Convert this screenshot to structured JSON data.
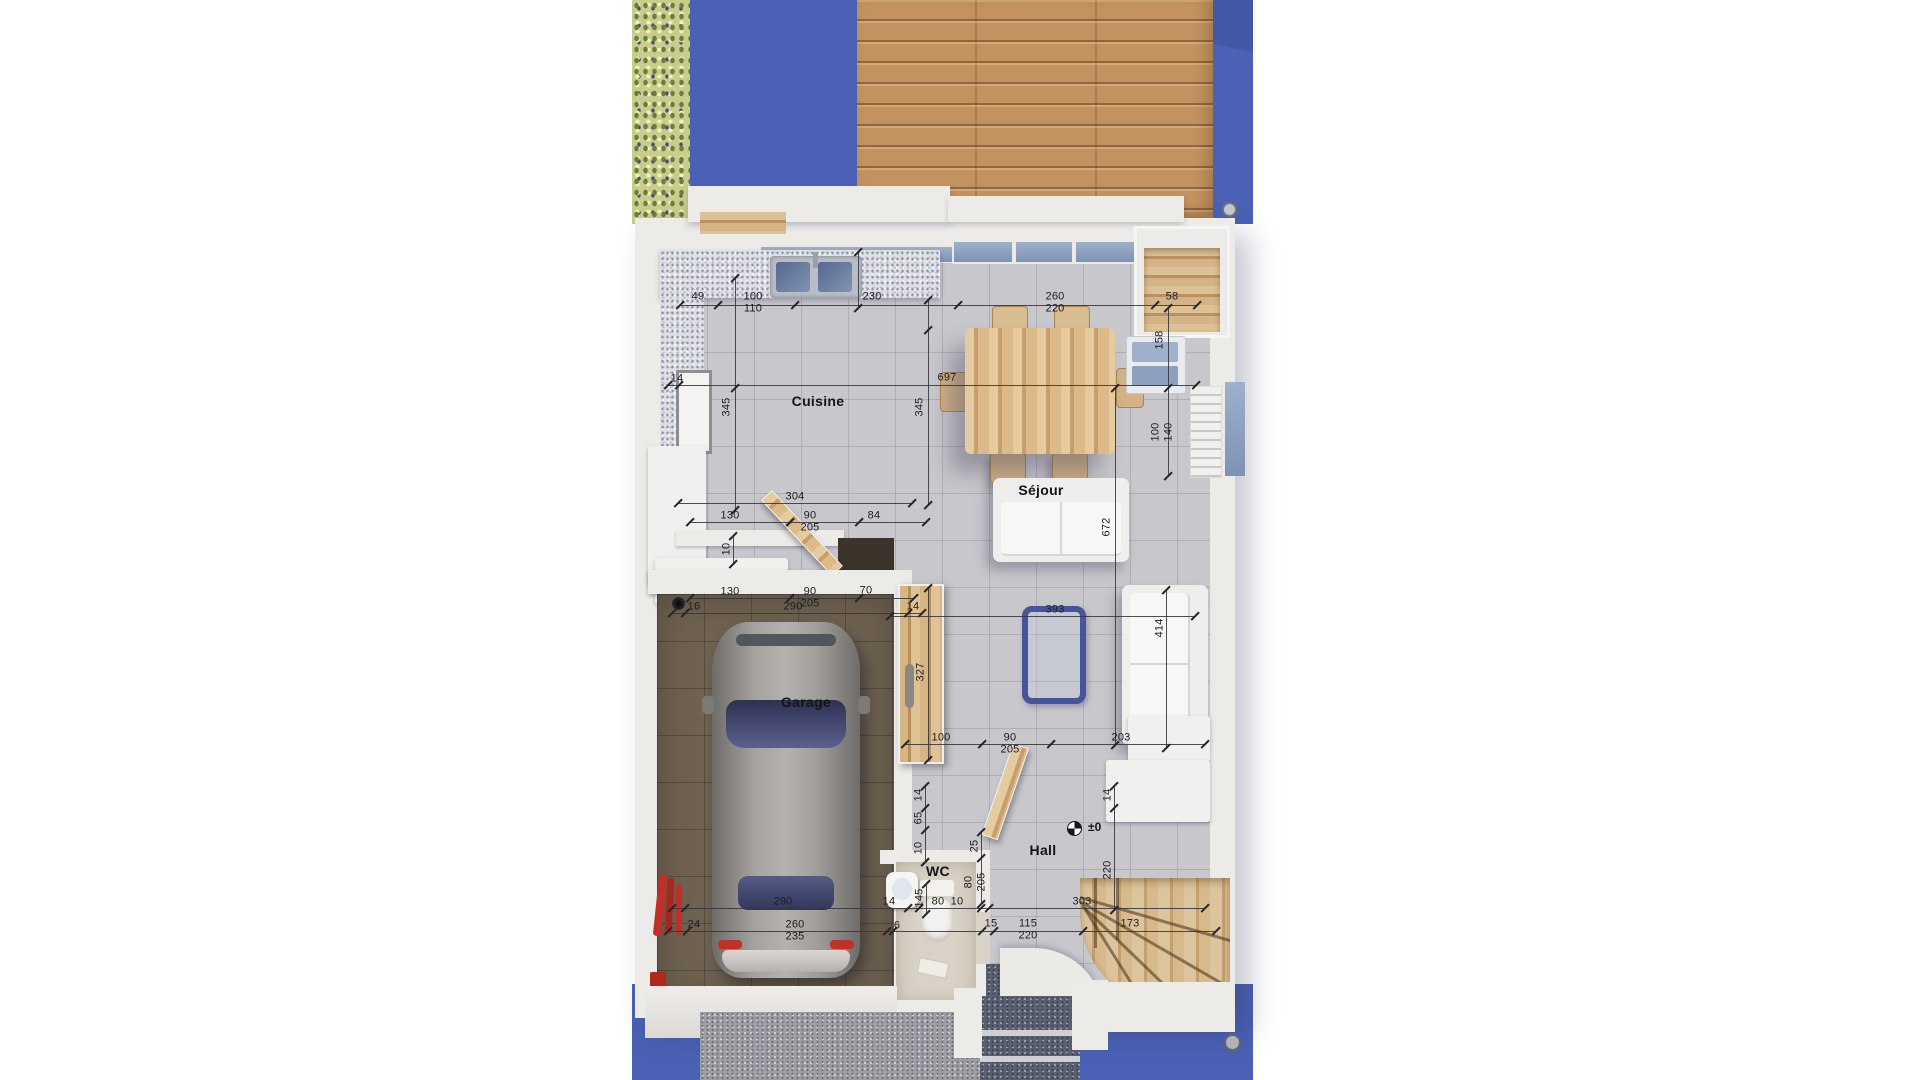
{
  "scene": {
    "type": "3d-rendered-floor-plan",
    "view": "top-down"
  },
  "colors": {
    "ground_blue": "#4a61b5",
    "deck_wood": "#c2935f",
    "hedge_green": "#c9cd8c",
    "wall_white": "#ecebe8",
    "floor_tile": "#c8c7cc",
    "garage_floor": "#6f6251",
    "annotation": "#1c1c1f",
    "coffee_table_blue": "#46549c",
    "taillight_red": "#c03028"
  },
  "room_labels": [
    {
      "id": "cuisine",
      "label": "Cuisine",
      "x": 818,
      "y": 401
    },
    {
      "id": "sejour",
      "label": "Séjour",
      "x": 1041,
      "y": 490
    },
    {
      "id": "garage",
      "label": "Garage",
      "x": 806,
      "y": 702
    },
    {
      "id": "wc",
      "label": "WC",
      "x": 938,
      "y": 871
    },
    {
      "id": "hall",
      "label": "Hall",
      "x": 1043,
      "y": 850
    }
  ],
  "level_marker": {
    "label": "±0",
    "sym_x": 1067,
    "sym_y": 821,
    "x": 1088,
    "y": 820
  },
  "dim_labels": [
    {
      "t": "49",
      "x": 698,
      "y": 297
    },
    {
      "t": "100",
      "x": 753,
      "y": 297
    },
    {
      "t": "110",
      "x": 753,
      "y": 309
    },
    {
      "t": "230",
      "x": 872,
      "y": 297
    },
    {
      "t": "260",
      "x": 1055,
      "y": 297
    },
    {
      "t": "220",
      "x": 1055,
      "y": 309
    },
    {
      "t": "58",
      "x": 1172,
      "y": 297
    },
    {
      "t": "14",
      "x": 677,
      "y": 379
    },
    {
      "t": "697",
      "x": 947,
      "y": 378
    },
    {
      "t": "345",
      "x": 727,
      "y": 407,
      "r": 1
    },
    {
      "t": "345",
      "x": 920,
      "y": 407,
      "r": 1
    },
    {
      "t": "158",
      "x": 1160,
      "y": 340,
      "r": 1
    },
    {
      "t": "100",
      "x": 1156,
      "y": 432,
      "r": 1
    },
    {
      "t": "140",
      "x": 1169,
      "y": 432,
      "r": 1
    },
    {
      "t": "672",
      "x": 1107,
      "y": 527,
      "r": 1
    },
    {
      "t": "414",
      "x": 1160,
      "y": 628,
      "r": 1
    },
    {
      "t": "327",
      "x": 921,
      "y": 672,
      "r": 1
    },
    {
      "t": "10",
      "x": 727,
      "y": 549,
      "r": 1
    },
    {
      "t": "304",
      "x": 795,
      "y": 497
    },
    {
      "t": "130",
      "x": 730,
      "y": 516
    },
    {
      "t": "90",
      "x": 810,
      "y": 516
    },
    {
      "t": "205",
      "x": 810,
      "y": 528
    },
    {
      "t": "84",
      "x": 874,
      "y": 516
    },
    {
      "t": "130",
      "x": 730,
      "y": 592
    },
    {
      "t": "90",
      "x": 810,
      "y": 592
    },
    {
      "t": "205",
      "x": 810,
      "y": 604
    },
    {
      "t": "70",
      "x": 866,
      "y": 591
    },
    {
      "t": "16",
      "x": 694,
      "y": 607
    },
    {
      "t": "290",
      "x": 793,
      "y": 607
    },
    {
      "t": "14",
      "x": 913,
      "y": 607
    },
    {
      "t": "393",
      "x": 1055,
      "y": 610
    },
    {
      "t": "100",
      "x": 941,
      "y": 738
    },
    {
      "t": "90",
      "x": 1010,
      "y": 738
    },
    {
      "t": "205",
      "x": 1010,
      "y": 750
    },
    {
      "t": "203",
      "x": 1121,
      "y": 738
    },
    {
      "t": "14",
      "x": 919,
      "y": 795,
      "r": 1
    },
    {
      "t": "65",
      "x": 919,
      "y": 818,
      "r": 1
    },
    {
      "t": "10",
      "x": 919,
      "y": 848,
      "r": 1
    },
    {
      "t": "25",
      "x": 975,
      "y": 846,
      "r": 1
    },
    {
      "t": "80",
      "x": 969,
      "y": 882,
      "r": 1
    },
    {
      "t": "205",
      "x": 982,
      "y": 882,
      "r": 1
    },
    {
      "t": "14",
      "x": 1108,
      "y": 795,
      "r": 1
    },
    {
      "t": "220",
      "x": 1108,
      "y": 870,
      "r": 1
    },
    {
      "t": "145",
      "x": 920,
      "y": 898,
      "r": 1
    },
    {
      "t": "290",
      "x": 783,
      "y": 902
    },
    {
      "t": "14",
      "x": 889,
      "y": 902
    },
    {
      "t": "80",
      "x": 938,
      "y": 902
    },
    {
      "t": "10",
      "x": 957,
      "y": 902
    },
    {
      "t": "303",
      "x": 1082,
      "y": 902
    },
    {
      "t": "24",
      "x": 694,
      "y": 925
    },
    {
      "t": "260",
      "x": 795,
      "y": 925
    },
    {
      "t": "235",
      "x": 795,
      "y": 937
    },
    {
      "t": "6",
      "x": 897,
      "y": 926
    },
    {
      "t": "15",
      "x": 991,
      "y": 924
    },
    {
      "t": "115",
      "x": 1028,
      "y": 924
    },
    {
      "t": "220",
      "x": 1028,
      "y": 936
    },
    {
      "t": "173",
      "x": 1130,
      "y": 924
    }
  ],
  "dim_lines": [
    {
      "x": 680,
      "y": 305,
      "l": 517,
      "o": "h"
    },
    {
      "x": 668,
      "y": 385,
      "l": 528,
      "o": "h"
    },
    {
      "x": 678,
      "y": 503,
      "l": 234,
      "o": "h"
    },
    {
      "x": 690,
      "y": 522,
      "l": 236,
      "o": "h"
    },
    {
      "x": 690,
      "y": 598,
      "l": 224,
      "o": "h"
    },
    {
      "x": 672,
      "y": 613,
      "l": 250,
      "o": "h"
    },
    {
      "x": 890,
      "y": 616,
      "l": 305,
      "o": "h"
    },
    {
      "x": 905,
      "y": 744,
      "l": 300,
      "o": "h"
    },
    {
      "x": 672,
      "y": 908,
      "l": 533,
      "o": "h"
    },
    {
      "x": 668,
      "y": 931,
      "l": 548,
      "o": "h"
    },
    {
      "x": 735,
      "y": 278,
      "l": 232,
      "o": "v"
    },
    {
      "x": 928,
      "y": 300,
      "l": 205,
      "o": "v"
    },
    {
      "x": 1168,
      "y": 308,
      "l": 168,
      "o": "v"
    },
    {
      "x": 1115,
      "y": 388,
      "l": 357,
      "o": "v"
    },
    {
      "x": 928,
      "y": 588,
      "l": 172,
      "o": "v"
    },
    {
      "x": 1166,
      "y": 590,
      "l": 158,
      "o": "v"
    },
    {
      "x": 733,
      "y": 536,
      "l": 28,
      "o": "v"
    },
    {
      "x": 925,
      "y": 786,
      "l": 76,
      "o": "v"
    },
    {
      "x": 981,
      "y": 832,
      "l": 72,
      "o": "v"
    },
    {
      "x": 1114,
      "y": 786,
      "l": 124,
      "o": "v"
    },
    {
      "x": 926,
      "y": 884,
      "l": 30,
      "o": "v"
    },
    {
      "x": 858,
      "y": 252,
      "l": 56,
      "o": "v"
    }
  ],
  "ticks": [
    [
      718,
      305
    ],
    [
      795,
      305
    ],
    [
      958,
      305
    ],
    [
      1155,
      305
    ],
    [
      679,
      385
    ],
    [
      790,
      522
    ],
    [
      859,
      522
    ],
    [
      790,
      598
    ],
    [
      859,
      598
    ],
    [
      685,
      613
    ],
    [
      908,
      613
    ],
    [
      982,
      744
    ],
    [
      1051,
      744
    ],
    [
      685,
      908
    ],
    [
      908,
      908
    ],
    [
      919,
      908
    ],
    [
      981,
      908
    ],
    [
      989,
      908
    ],
    [
      687,
      931
    ],
    [
      887,
      931
    ],
    [
      893,
      931
    ],
    [
      982,
      931
    ],
    [
      994,
      931
    ],
    [
      1083,
      931
    ],
    [
      735,
      388
    ],
    [
      928,
      330
    ],
    [
      1168,
      388
    ],
    [
      925,
      808
    ],
    [
      925,
      830
    ],
    [
      925,
      862
    ],
    [
      1114,
      808
    ],
    [
      981,
      858
    ]
  ]
}
